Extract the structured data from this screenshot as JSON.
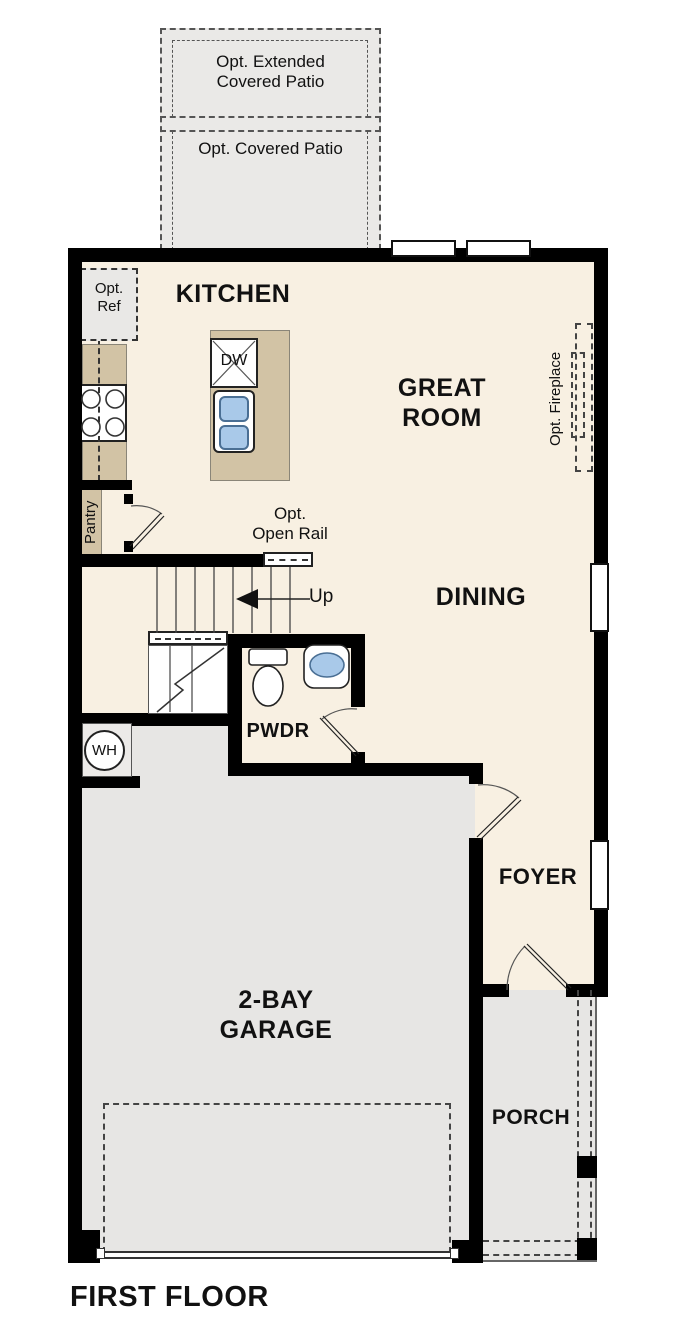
{
  "title": "FIRST FLOOR",
  "rooms": {
    "kitchen": "KITCHEN",
    "great_room": "GREAT\nROOM",
    "dining": "DINING",
    "powder": "PWDR",
    "foyer": "FOYER",
    "garage": "2-BAY\nGARAGE",
    "porch": "PORCH"
  },
  "options": {
    "extended_patio": "Opt. Extended\nCovered Patio",
    "covered_patio": "Opt. Covered Patio",
    "refrigerator": "Opt.\nRef",
    "fireplace": "Opt. Fireplace",
    "open_rail": "Opt.\nOpen Rail"
  },
  "fixtures": {
    "dishwasher": "DW",
    "water_heater": "WH",
    "pantry": "Pantry",
    "stairs_direction": "Up"
  },
  "colors": {
    "floor": "#f8f0e2",
    "hard_surface": "#e7e6e4",
    "counter": "#d2c3a5",
    "fixture_blue": "#a9c9e9",
    "wall": "#000000"
  }
}
